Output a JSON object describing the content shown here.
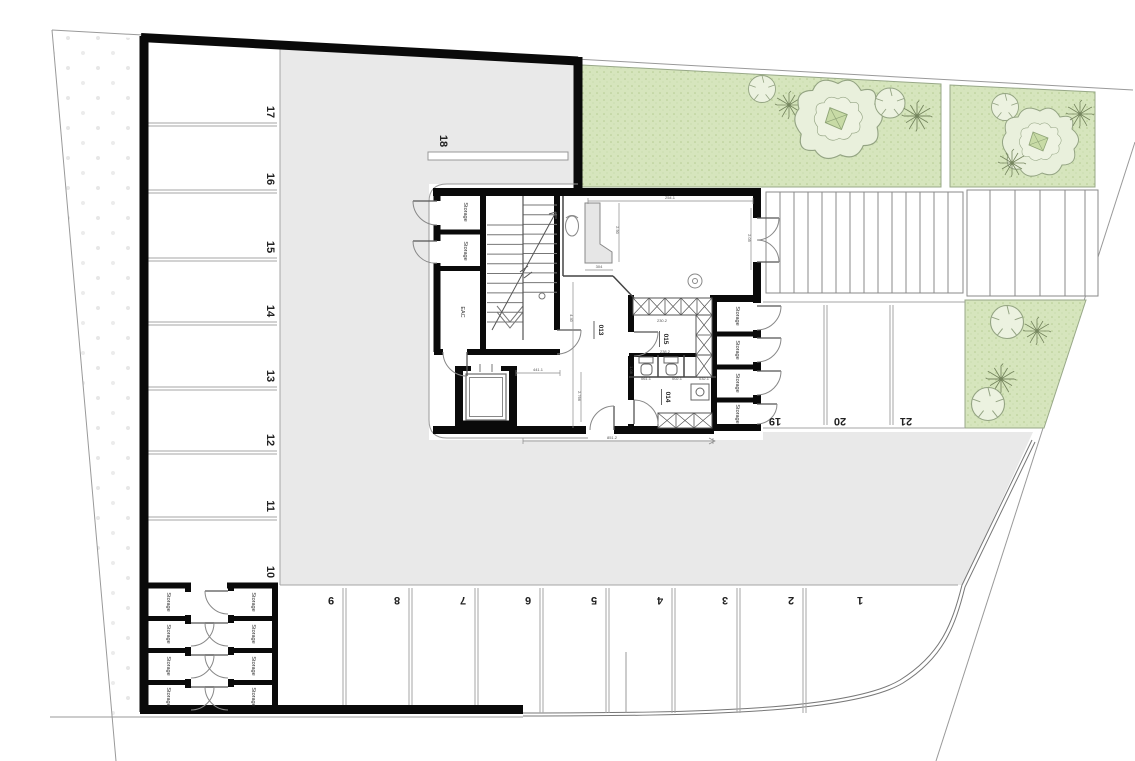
{
  "plan": {
    "title": "Basement parking floor plan",
    "parking_left": [
      "17",
      "16",
      "15",
      "14",
      "13",
      "12",
      "11",
      "10"
    ],
    "parking_bottom": [
      "9",
      "8",
      "7",
      "6",
      "5",
      "4",
      "3",
      "2",
      "1"
    ],
    "parking_right": [
      "19",
      "20",
      "21"
    ],
    "parking_island": "18",
    "labels": {
      "storage": "Storage",
      "eac": "EAC"
    },
    "rooms": {
      "r013": "013",
      "r014": "014",
      "r015": "015"
    },
    "dims": [
      "254.1",
      "2.05",
      "2.90",
      "304",
      "4.40",
      "441.1",
      "2.766",
      "851.2",
      "230.2",
      "238.2",
      "061.1",
      "002.1",
      "1.08",
      "032.1"
    ],
    "colors": {
      "wall": "#0a0a0a",
      "aisle": "#e9e9e9",
      "grass": "#d6e5bd",
      "line": "#999999",
      "tree_outline": "#94a483"
    }
  }
}
